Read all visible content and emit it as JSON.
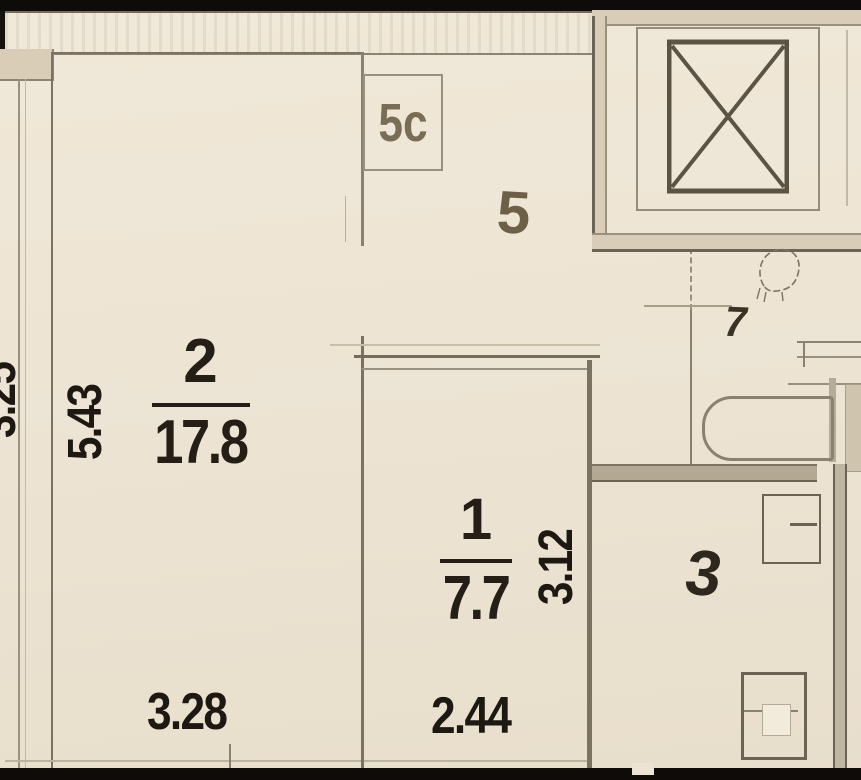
{
  "plan_type": "apartment-floor-plan",
  "labels": {
    "room2_number": "2",
    "room2_area": "17.8",
    "room2_height_dim": "5.43",
    "room2_width_dim": "3.28",
    "room1_number": "1",
    "room1_area": "7.7",
    "room1_height_dim": "3.12",
    "room1_width_dim": "2.44",
    "room5_number": "5",
    "closet5c_number": "5c",
    "room7_number": "7",
    "room3_number": "3",
    "left_partial_dim": "3.25"
  },
  "colors": {
    "background": "#ece3d3",
    "wall_dark": "#6b6354",
    "wall_mid": "#8a8171",
    "wall_fill": "#d9cdb7",
    "band_black": "#0e0c09",
    "dimension_text": "#1d1812",
    "room_label_brown": "#70634b"
  }
}
